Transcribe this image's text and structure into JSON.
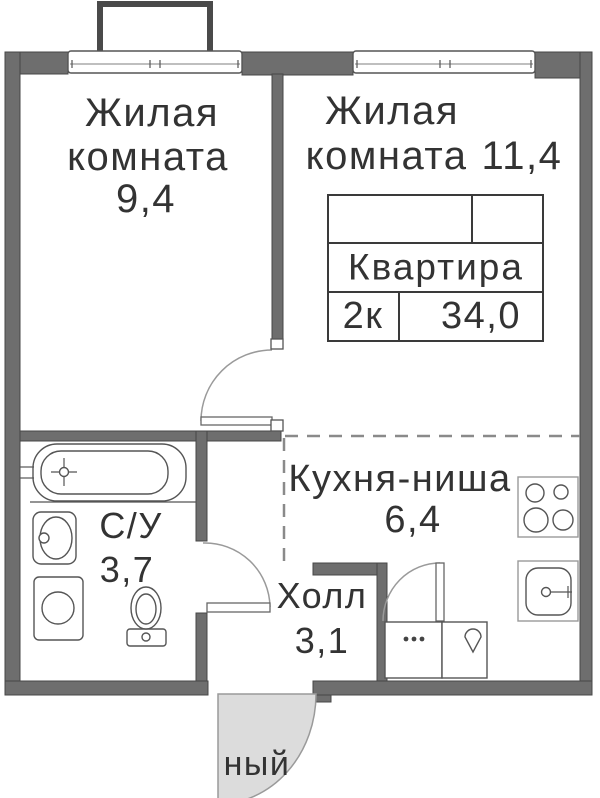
{
  "colors": {
    "wall": "#6e6e6e",
    "wall_edge": "#474747",
    "line": "#555555",
    "dash": "#8a8a8a",
    "door_fill": "#dcdcdc",
    "text": "#333333",
    "bg": "#ffffff"
  },
  "info_table": {
    "title": "Квартира",
    "type": "2к",
    "area": "34,0"
  },
  "rooms": {
    "living1": {
      "name_l1": "Жилая",
      "name_l2": "комната",
      "area": "9,4"
    },
    "living2": {
      "name_l1": "Жилая",
      "name_l2": "комната",
      "area": "11,4"
    },
    "kitchen": {
      "name": "Кухня-ниша",
      "area": "6,4"
    },
    "hall": {
      "name": "Холл",
      "area": "3,1"
    },
    "bathroom": {
      "name": "С/У",
      "area": "3,7"
    }
  },
  "clipped_text": "ный",
  "fixtures": [
    "bathtub",
    "bath-sink",
    "washing-machine",
    "toilet",
    "stove",
    "kitchen-sink",
    "cabinet-dots",
    "cabinet-drop",
    "balcony",
    "window",
    "door-swing",
    "entrance-door"
  ]
}
